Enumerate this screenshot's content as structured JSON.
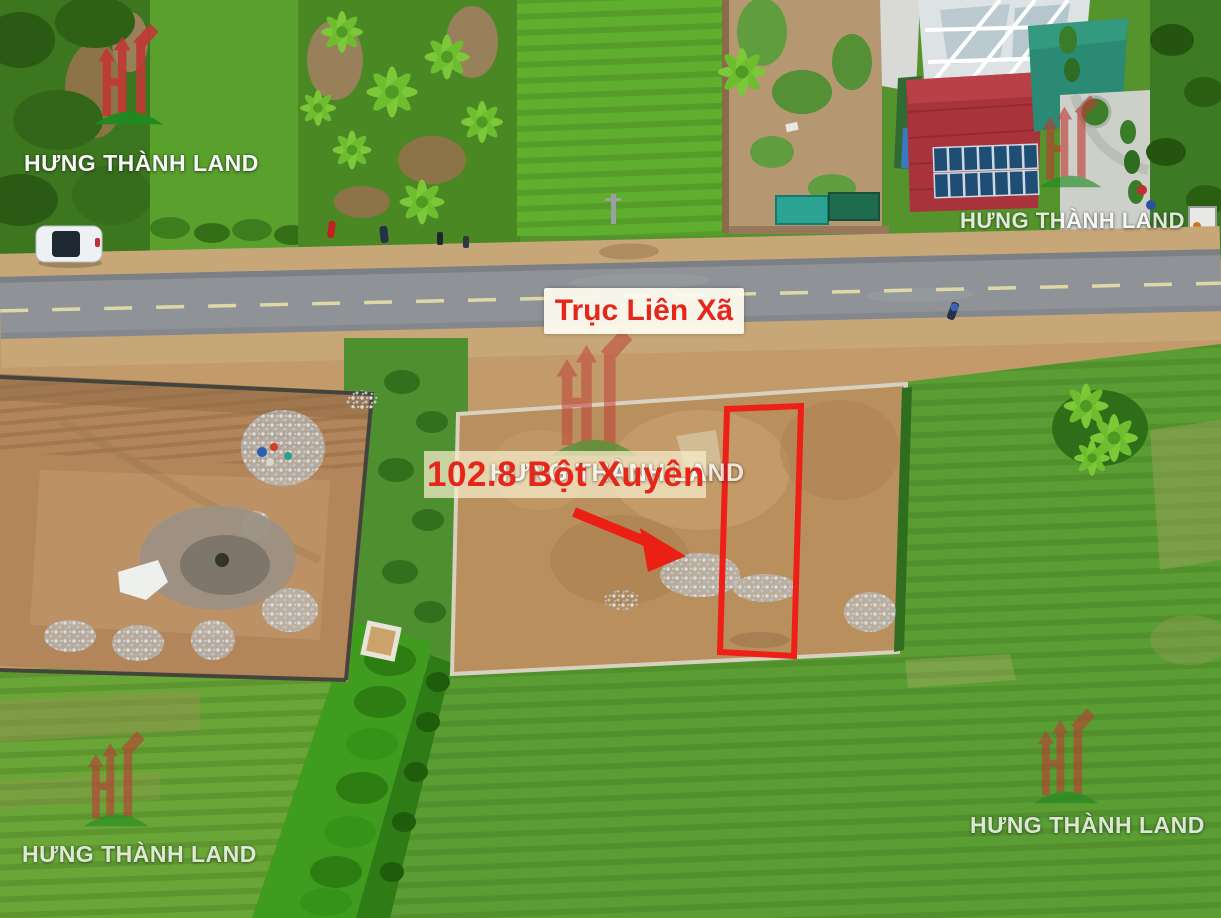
{
  "brand": {
    "name": "HƯNG THÀNH LAND",
    "logo_colors": {
      "red": "#bf3a34",
      "green": "#1e8a1e"
    }
  },
  "annotations": {
    "road_sign": "Trục Liên Xã",
    "plot_label": "102.8 Bột Xuyên",
    "accent_red": "#ea2015",
    "label_bg": "#f6eecd"
  }
}
